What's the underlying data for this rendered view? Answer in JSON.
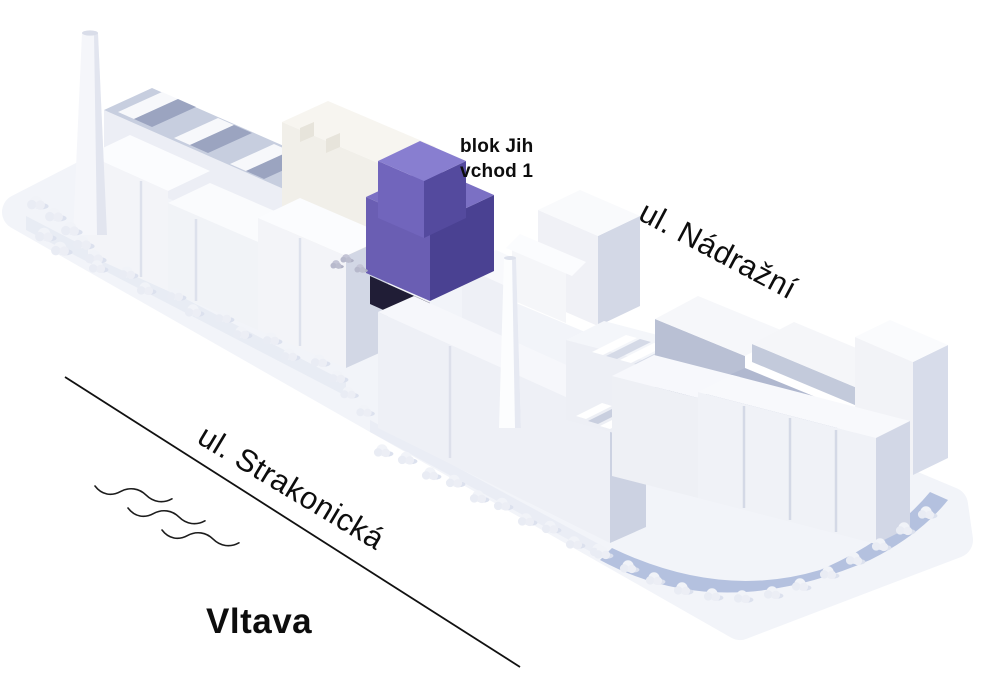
{
  "labels": {
    "building_line1": "blok Jih",
    "building_line2": "vchod 1",
    "street_top": "ul. Nádražní",
    "street_bottom": "ul. Strakonická",
    "river": "Vltava"
  },
  "colors": {
    "highlight_top": "#7b70c4",
    "highlight_front": "#6a5eb3",
    "highlight_side": "#4a4192",
    "highlight_top2": "#887ed0",
    "highlight_front2": "#7165bc",
    "highlight_side2": "#544a9e",
    "highlight_shadow": "#201d36",
    "ink": "#0d0d0d"
  }
}
